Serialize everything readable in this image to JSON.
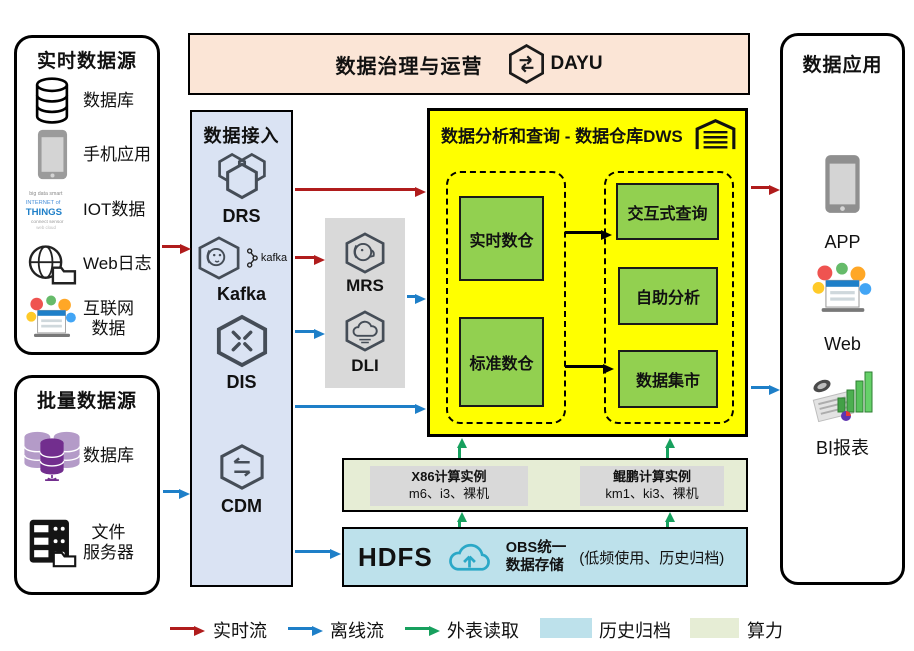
{
  "colors": {
    "realtime_flow": "#B01C1C",
    "offline_flow": "#1E7FC8",
    "external_read": "#17A05E",
    "history_archive_bg": "#BDE1EB",
    "compute_power_bg": "#E6EDD5",
    "dws_bg": "#FFFF00",
    "module_green": "#92D050",
    "ingestion_bg": "#DAE3F3",
    "processing_bg": "#D9D9D9",
    "banner_bg": "#FBE5D6"
  },
  "realtime_sources": {
    "title": "实时数据源",
    "items": [
      {
        "label": "数据库",
        "icon": "database-icon"
      },
      {
        "label": "手机应用",
        "icon": "phone-icon"
      },
      {
        "label": "IOT数据",
        "icon": "iot-icon",
        "icon_text_1": "INTERNET of",
        "icon_text_2": "THINGS"
      },
      {
        "label": "Web日志",
        "icon": "web-log-icon"
      },
      {
        "label": "互联网\n数据",
        "icon": "internet-data-icon"
      }
    ]
  },
  "batch_sources": {
    "title": "批量数据源",
    "items": [
      {
        "label": "数据库",
        "icon": "batch-database-icon"
      },
      {
        "label": "文件\n服务器",
        "icon": "file-server-icon"
      }
    ]
  },
  "governance": {
    "title": "数据治理与运营",
    "product": "DAYU"
  },
  "ingestion": {
    "title": "数据接入",
    "services": [
      "DRS",
      "Kafka",
      "DIS",
      "CDM"
    ],
    "kafka_logo": "kafka"
  },
  "processing": {
    "services": [
      "MRS",
      "DLI"
    ]
  },
  "dws": {
    "title": "数据分析和查询 - 数据仓库DWS",
    "left_modules": [
      "实时数仓",
      "标准数仓"
    ],
    "right_modules": [
      "交互式查询",
      "自助分析",
      "数据集市"
    ]
  },
  "compute": {
    "instances": [
      {
        "name": "X86计算实例",
        "spec": "m6、i3、裸机"
      },
      {
        "name": "鲲鹏计算实例",
        "spec": "km1、ki3、裸机"
      }
    ]
  },
  "storage": {
    "hdfs": "HDFS",
    "obs": "OBS统一\n数据存储",
    "note": "(低频使用、历史归档)"
  },
  "applications": {
    "title": "数据应用",
    "items": [
      "APP",
      "Web",
      "BI报表"
    ]
  },
  "legend": {
    "items": [
      {
        "label": "实时流",
        "type": "arrow",
        "color": "#B01C1C"
      },
      {
        "label": "离线流",
        "type": "arrow",
        "color": "#1E7FC8"
      },
      {
        "label": "外表读取",
        "type": "arrow",
        "color": "#17A05E"
      },
      {
        "label": "历史归档",
        "type": "swatch",
        "color": "#BDE1EB"
      },
      {
        "label": "算力",
        "type": "swatch",
        "color": "#E6EDD5"
      }
    ]
  }
}
